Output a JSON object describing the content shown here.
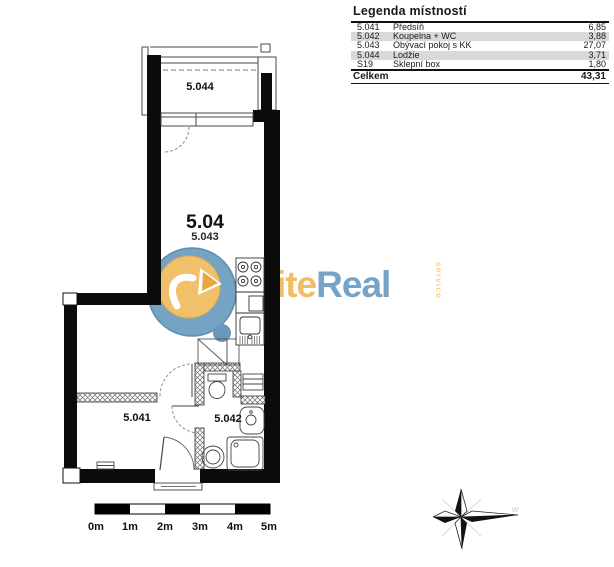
{
  "legend": {
    "title": "Legenda místností",
    "rows": [
      {
        "code": "5.041",
        "name": "Předsíň",
        "area": "6,85"
      },
      {
        "code": "5.042",
        "name": "Koupelna + WC",
        "area": "3,88"
      },
      {
        "code": "5.043",
        "name": "Obývací pokoj s KK",
        "area": "27,07"
      },
      {
        "code": "5.044",
        "name": "Lodžie",
        "area": "3,71"
      },
      {
        "code": "S19",
        "name": "Sklepní box",
        "area": "1,80"
      }
    ],
    "total": {
      "label": "Celkem",
      "value": "43,31"
    }
  },
  "plan": {
    "unit_label": "5.04",
    "rooms": {
      "living": "5.043",
      "hall": "5.041",
      "bath": "5.042",
      "balcony": "5.044"
    }
  },
  "scale_bar": {
    "labels": [
      "0m",
      "1m",
      "2m",
      "3m",
      "4m",
      "5m"
    ]
  },
  "logo": {
    "elite": "Elite",
    "real": "Real",
    "service": "service"
  },
  "compass": {
    "faint_mark": "w"
  },
  "colors": {
    "logo_orange": "#f0bd66",
    "logo_blue": "#76a3c6",
    "legend_stripe": "#d9d9d9",
    "wall_black": "#0b0b0b"
  }
}
